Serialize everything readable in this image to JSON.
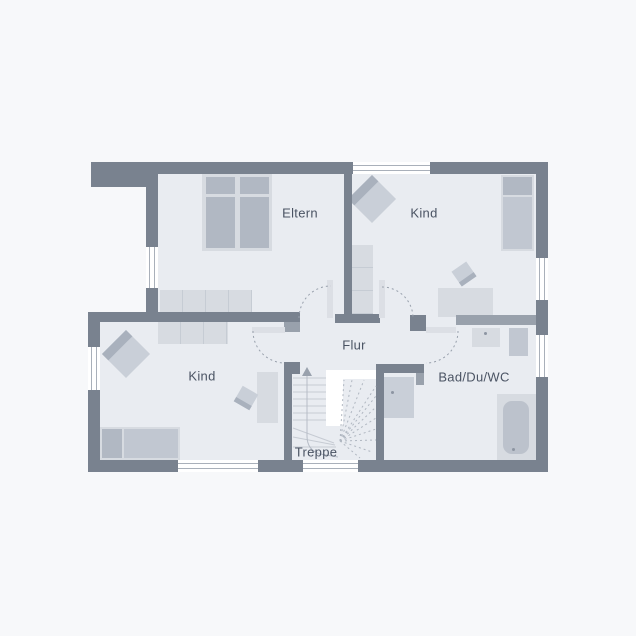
{
  "plan_title": "Obergeschoss Grundriss",
  "rooms": [
    {
      "key": "eltern",
      "label": "Eltern"
    },
    {
      "key": "kind_top",
      "label": "Kind"
    },
    {
      "key": "kind_bottom",
      "label": "Kind"
    },
    {
      "key": "flur",
      "label": "Flur"
    },
    {
      "key": "treppe",
      "label": "Treppe"
    },
    {
      "key": "bad",
      "label": "Bad/Du/WC"
    }
  ],
  "colors": {
    "wall": "#79828f",
    "wall_light": "#99a1ac",
    "floor": "#e9ecf1",
    "background": "#f7f8fa",
    "furniture": "#d7dbe1",
    "furniture_dark": "#b1b8c3",
    "furniture_mid": "#c1c7d1",
    "line": "#9aa2ae",
    "text": "#4a5363",
    "window": "#ffffff"
  }
}
